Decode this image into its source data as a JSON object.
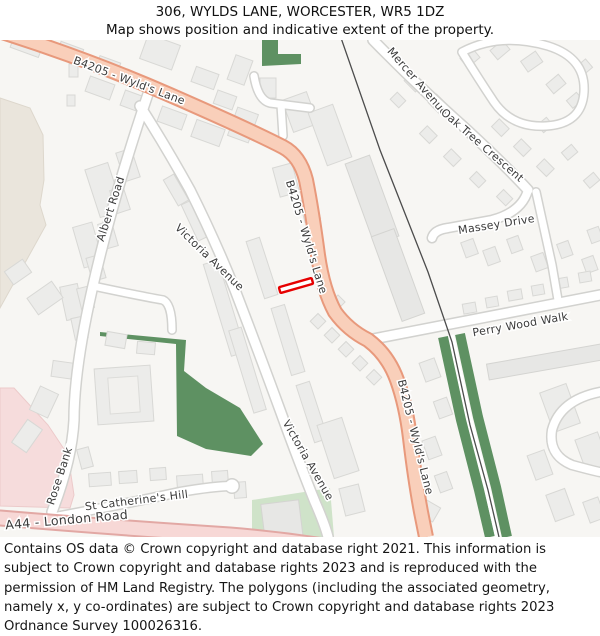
{
  "header": {
    "title": "306, WYLDS LANE, WORCESTER, WR5 1DZ",
    "subtitle": "Map shows position and indicative extent of the property."
  },
  "map": {
    "labels": {
      "b4205_top": "B4205 - Wyld's Lane",
      "b4205_mid": "B4205 - Wyld's Lane",
      "b4205_bottom": "B4205 - Wyld's Lane",
      "albert_road": "Albert Road",
      "victoria_avenue_upper": "Victoria Avenue",
      "victoria_avenue_lower": "Victoria Avenue",
      "mercer_avenue": "Mercer Avenue",
      "oak_tree_crescent": "Oak Tree Crescent",
      "massey_drive": "Massey Drive",
      "perry_wood_walk": "Perry Wood Walk",
      "rose_bank": "Rose Bank",
      "st_catherines_hill": "St Catherine's Hill",
      "a44_london_road": "A44 - London Road"
    },
    "colors": {
      "primary_road_fill": "#f9cfba",
      "primary_road_border": "#e8997c",
      "a_road_fill": "#f7d8d6",
      "a_road_border": "#e2a8a4",
      "green_dark": "#5e9162",
      "green_light": "#cfe3c9",
      "beige_area": "#eae5dc",
      "pink_area": "#f6dcdc",
      "building_fill": "#ececea",
      "railway": "#4c4c4c",
      "property_outline": "#e60000",
      "background": "#f7f6f3"
    },
    "property_marker_label": "306 Wylds Lane indicative property extent"
  },
  "footer": {
    "text": "Contains OS data © Crown copyright and database right 2021. This information is subject to Crown copyright and database rights 2023 and is reproduced with the permission of HM Land Registry. The polygons (including the associated geometry, namely x, y co-ordinates) are subject to Crown copyright and database rights 2023 Ordnance Survey 100026316."
  }
}
